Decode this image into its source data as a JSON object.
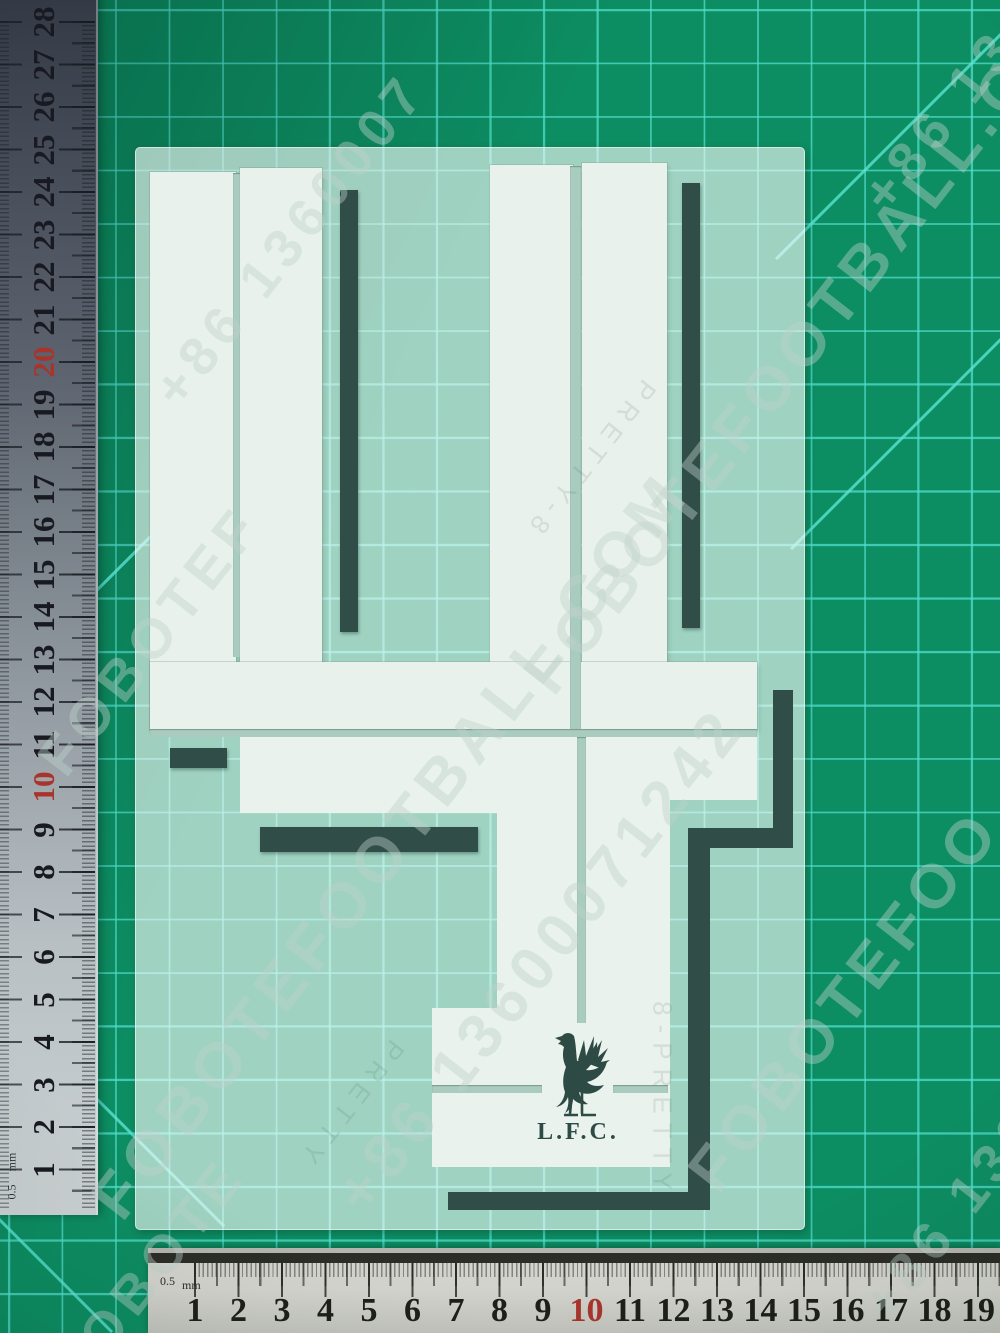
{
  "transfer": {
    "numeral": "4",
    "club_initials": "L.F.C.",
    "colors": {
      "vinyl_white": "#e8f1eb",
      "vinyl_dark_green": "#304d47",
      "sheet_tint": "#bcd9cf"
    }
  },
  "mat": {
    "base_color": "#0d8d62",
    "grid_color": "#50decd"
  },
  "left_ruler": {
    "numbers": [
      "28",
      "27",
      "26",
      "25",
      "24",
      "23",
      "22",
      "21",
      "20",
      "19",
      "18",
      "17",
      "16",
      "15",
      "14",
      "13",
      "12",
      "11",
      "10",
      "9",
      "8",
      "7",
      "6",
      "5",
      "4",
      "3",
      "2",
      "1"
    ],
    "red_numbers": [
      "20",
      "10"
    ],
    "half_label": "0.5",
    "unit_label": "mm"
  },
  "bottom_ruler": {
    "numbers": [
      "1",
      "2",
      "3",
      "4",
      "5",
      "6",
      "7",
      "8",
      "9",
      "10",
      "11",
      "12",
      "13",
      "14",
      "15",
      "16",
      "17",
      "18",
      "19"
    ],
    "red_numbers": [
      "10"
    ],
    "half_label": "0.5",
    "unit_label": "mm"
  },
  "watermarks": {
    "items": [
      {
        "text": "+86 1360007",
        "x": 290,
        "y": 240,
        "size": 54
      },
      {
        "text": "FOBOTEFOOTBALL.COM",
        "x": 390,
        "y": 845,
        "size": 64
      },
      {
        "text": "+86 13600071242",
        "x": 540,
        "y": 960,
        "size": 62
      },
      {
        "text": "FOBOTEF",
        "x": 150,
        "y": 640,
        "size": 56
      },
      {
        "text": "FOBOTEFOOTBALL.COM",
        "x": 815,
        "y": 330,
        "size": 62
      },
      {
        "text": "+86 13",
        "x": 940,
        "y": 120,
        "size": 54
      },
      {
        "text": "FOBOTEFOO",
        "x": 845,
        "y": 1000,
        "size": 62
      },
      {
        "text": "+86 136",
        "x": 952,
        "y": 1215,
        "size": 54
      },
      {
        "text": "FOBOTE",
        "x": 150,
        "y": 1272,
        "size": 54
      }
    ]
  },
  "faint_marks": {
    "items": [
      {
        "text": "PRETTY-8",
        "x": 590,
        "y": 460,
        "rot": 128
      },
      {
        "text": "8-PRETTY",
        "x": 662,
        "y": 1100,
        "rot": 90
      },
      {
        "text": "PRETTY",
        "x": 350,
        "y": 1105,
        "rot": 128
      }
    ]
  }
}
